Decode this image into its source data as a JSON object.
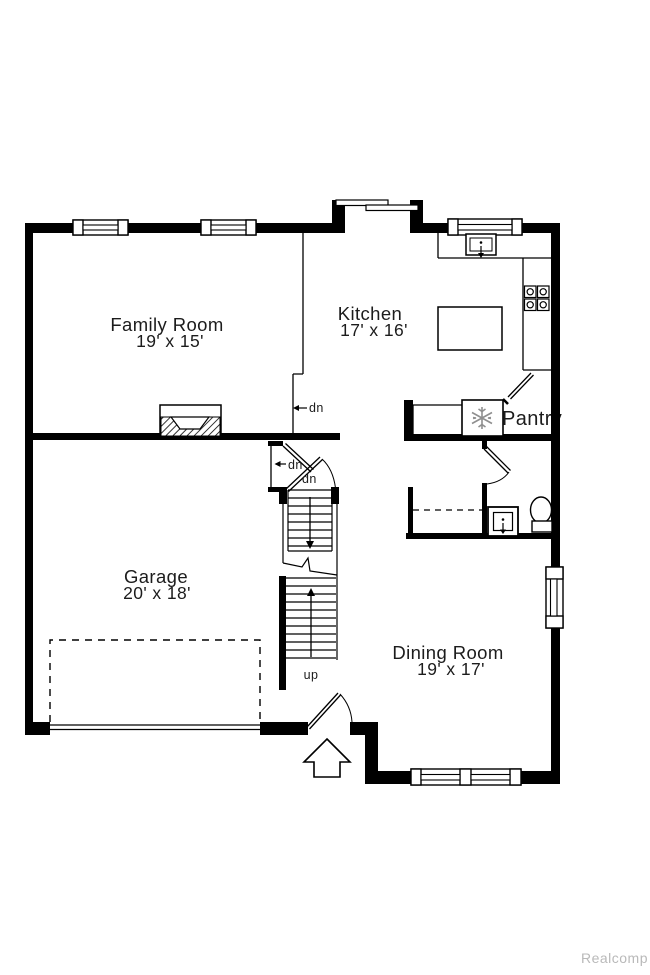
{
  "floorplan": {
    "rooms": [
      {
        "id": "family-room",
        "name": "Family Room",
        "dims": "19' x 15'"
      },
      {
        "id": "kitchen",
        "name": "Kitchen",
        "dims": "17' x 16'"
      },
      {
        "id": "garage",
        "name": "Garage",
        "dims": "20' x 18'"
      },
      {
        "id": "dining-room",
        "name": "Dining Room",
        "dims": "19' x 17'"
      }
    ],
    "features": {
      "pantry": "Pantry",
      "step_down": "dn",
      "basement_door_down": "dn",
      "basement_stairs_down": "dn",
      "stairs_up": "up"
    },
    "watermark": "Realcomp",
    "colors": {
      "walls": "#000000",
      "lines": "#1c1c1c",
      "appliance_gray": "#8f8f8f",
      "watermark": "#b9b9b9"
    }
  }
}
